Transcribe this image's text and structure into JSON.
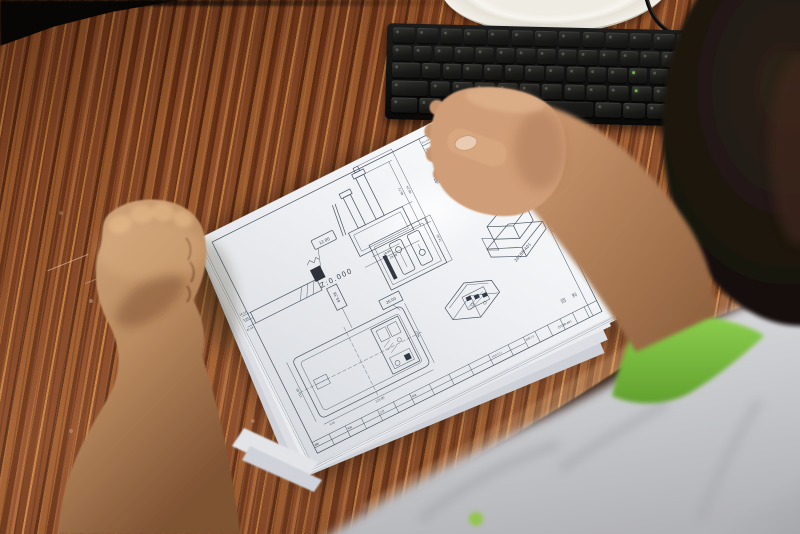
{
  "drawing": {
    "title_text": "吸镶件",
    "z_reference": "Z:0.000",
    "part_number": "20188-A01",
    "corner_mark": "回 料",
    "labels": {
      "l1": "12.00",
      "l2": "65.38",
      "l3": "26.00"
    },
    "dimensions": {
      "d1": "16.14",
      "d2": "5.00",
      "d3": "41.44",
      "d4": "66.72",
      "d5": "98.24",
      "d6": "18.80",
      "d7": "28.88",
      "d8": "74.50",
      "d9": "115.00",
      "d10": "9.00",
      "d11": "115.00",
      "d12": "90.57"
    },
    "revision_row1": "标记 处数 分区 更改文件号",
    "revision_row2": "签名 日期",
    "side_column": "20188-A01",
    "title_block": {
      "c1": "编制",
      "c2": "审核",
      "c3": "工艺",
      "c4": "批准",
      "scale": "比例 1:1",
      "part_no": "20188-A01",
      "date": "2018.12.1"
    }
  },
  "keyboard": {
    "rows": [
      [
        1,
        1,
        1,
        1,
        1,
        1,
        1,
        1,
        1,
        1,
        1,
        1,
        1
      ],
      [
        1,
        1,
        1,
        1,
        1,
        1,
        1,
        1,
        1,
        1,
        1,
        1,
        1,
        2
      ],
      [
        1.5,
        1,
        1,
        1,
        1,
        1,
        1,
        1,
        1,
        1,
        1,
        1,
        1,
        1.5
      ],
      [
        1.8,
        1,
        1,
        1,
        1,
        1,
        1,
        1,
        1,
        1,
        1,
        2.2
      ],
      [
        1.3,
        1.1,
        1.3,
        6.2,
        1.3,
        1.1,
        1.1,
        1.3
      ]
    ],
    "green_keys": [
      [
        2,
        11
      ],
      [
        3,
        10
      ]
    ]
  }
}
